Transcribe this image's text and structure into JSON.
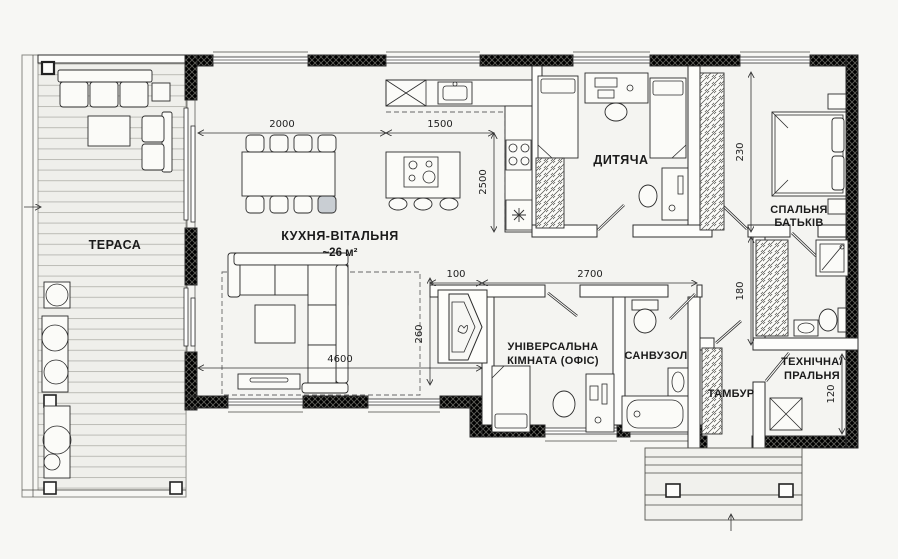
{
  "plan": {
    "rooms": {
      "terrace": {
        "label": "ТЕРАСА"
      },
      "kitchen_living": {
        "label": "КУХНЯ-ВІТАЛЬНЯ",
        "area": "~26 м²"
      },
      "children": {
        "label": "ДИТЯЧА"
      },
      "parents_bedroom": {
        "label1": "СПАЛЬНЯ",
        "label2": "БАТЬКІВ"
      },
      "office": {
        "label1": "УНІВЕРСАЛЬНА",
        "label2": "КІМНАТА (ОФІС)"
      },
      "bathroom": {
        "label": "САНВУЗОЛ"
      },
      "vestibule": {
        "label": "ТАМБУР"
      },
      "laundry": {
        "label1": "ТЕХНІЧНА/",
        "label2": "ПРАЛЬНЯ"
      }
    },
    "dimensions": {
      "living_width": "2000",
      "kitchen_width": "1500",
      "kitchen_depth": "2500",
      "bedroom_depth": "230",
      "hall_depth": "180",
      "fireplace_width": "100",
      "office_bath_width": "2700",
      "living_total_width": "4600",
      "living_depth": "260",
      "laundry_width": "120"
    },
    "colors": {
      "paper": "#f6f6f3",
      "line": "#2e2e2e",
      "deck_line": "#bcbcb6",
      "highlight_chair": "#c9ced3"
    }
  }
}
